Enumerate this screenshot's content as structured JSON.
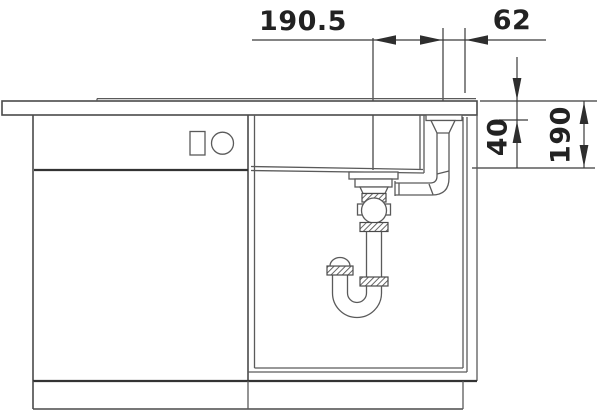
{
  "drawing": {
    "title": "sink-installation-section-drawing",
    "colors": {
      "background": "#ffffff",
      "line": "#555555",
      "dimension": "#333333",
      "text": "#222222"
    },
    "dims": {
      "drain_to_overflow": "190.5",
      "overflow_to_edge": "62",
      "top_offset": "40",
      "bowl_depth": "190"
    }
  }
}
